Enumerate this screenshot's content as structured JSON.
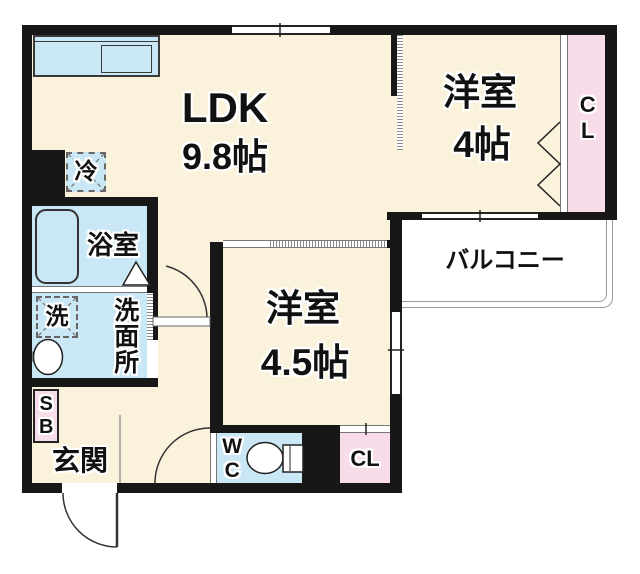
{
  "rooms": {
    "ldk": {
      "name": "LDK",
      "size": "9.8帖"
    },
    "bedroom_right": {
      "name": "洋室",
      "size": "4帖"
    },
    "bedroom_center": {
      "name": "洋室",
      "size": "4.5帖"
    },
    "bathroom": {
      "label": "浴室"
    },
    "washroom": {
      "label": "洗面所"
    },
    "entrance": {
      "label": "玄関"
    },
    "balcony": {
      "label": "バルコニー"
    },
    "toilet": {
      "label": "WC"
    },
    "closet_right": {
      "label": "CL"
    },
    "closet_lower": {
      "label": "CL"
    },
    "shoe_box": {
      "label": "SB"
    },
    "washer": {
      "label": "洗"
    },
    "refrigerator": {
      "label": "冷"
    }
  },
  "colors": {
    "room_fill": "#FBF2DB",
    "wet_area_fill": "#C9E7F4",
    "closet_fill": "#F9DCE9",
    "wall": "#171717",
    "balcony_fill": "#FFFFFF"
  }
}
